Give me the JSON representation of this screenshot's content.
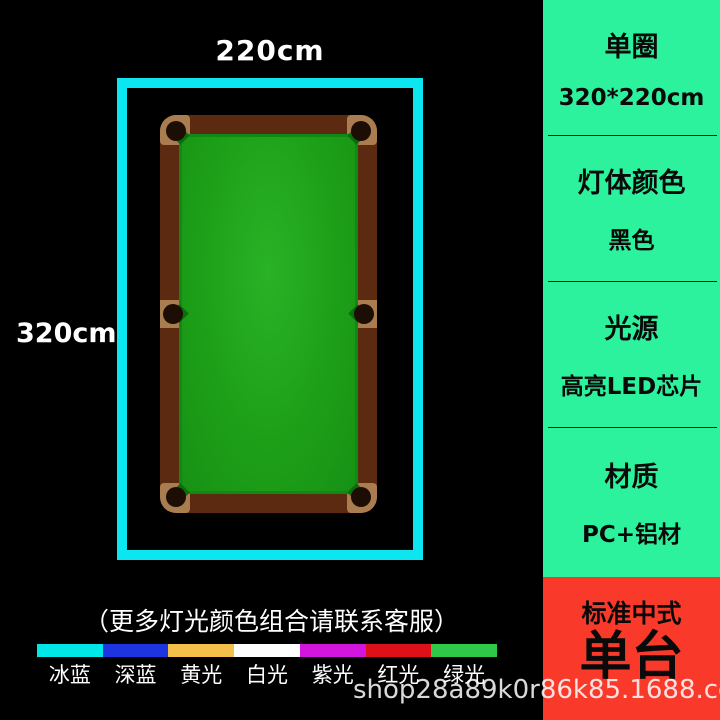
{
  "diagram": {
    "width_label": "220cm",
    "height_label": "320cm",
    "note": "（更多灯光颜色组合请联系客服）"
  },
  "light_options": [
    {
      "label": "冰蓝",
      "color": "#00e7e7"
    },
    {
      "label": "深蓝",
      "color": "#1c35e0"
    },
    {
      "label": "黄光",
      "color": "#f5c04a"
    },
    {
      "label": "白光",
      "color": "#ffffff"
    },
    {
      "label": "紫光",
      "color": "#d316de"
    },
    {
      "label": "红光",
      "color": "#de1019"
    },
    {
      "label": "绿光",
      "color": "#2fc94a"
    }
  ],
  "sidebar": {
    "sections": [
      {
        "title": "单圈",
        "value": "320*220cm"
      },
      {
        "title": "灯体颜色",
        "value": "黑色"
      },
      {
        "title": "光源",
        "value": "高亮LED芯片"
      },
      {
        "title": "材质",
        "value": "PC+铝材"
      }
    ]
  },
  "promo": {
    "line1": "标准中式",
    "line2": "单台"
  },
  "watermark": "shop28a89k0r86k85.1688.com",
  "colors": {
    "frame_cyan": "#0ce6f0",
    "sidebar_green": "#2df29d",
    "promo_red": "#f93a2b",
    "table_rail_brown": "#5b2a10",
    "table_felt_green": "#1da018"
  }
}
